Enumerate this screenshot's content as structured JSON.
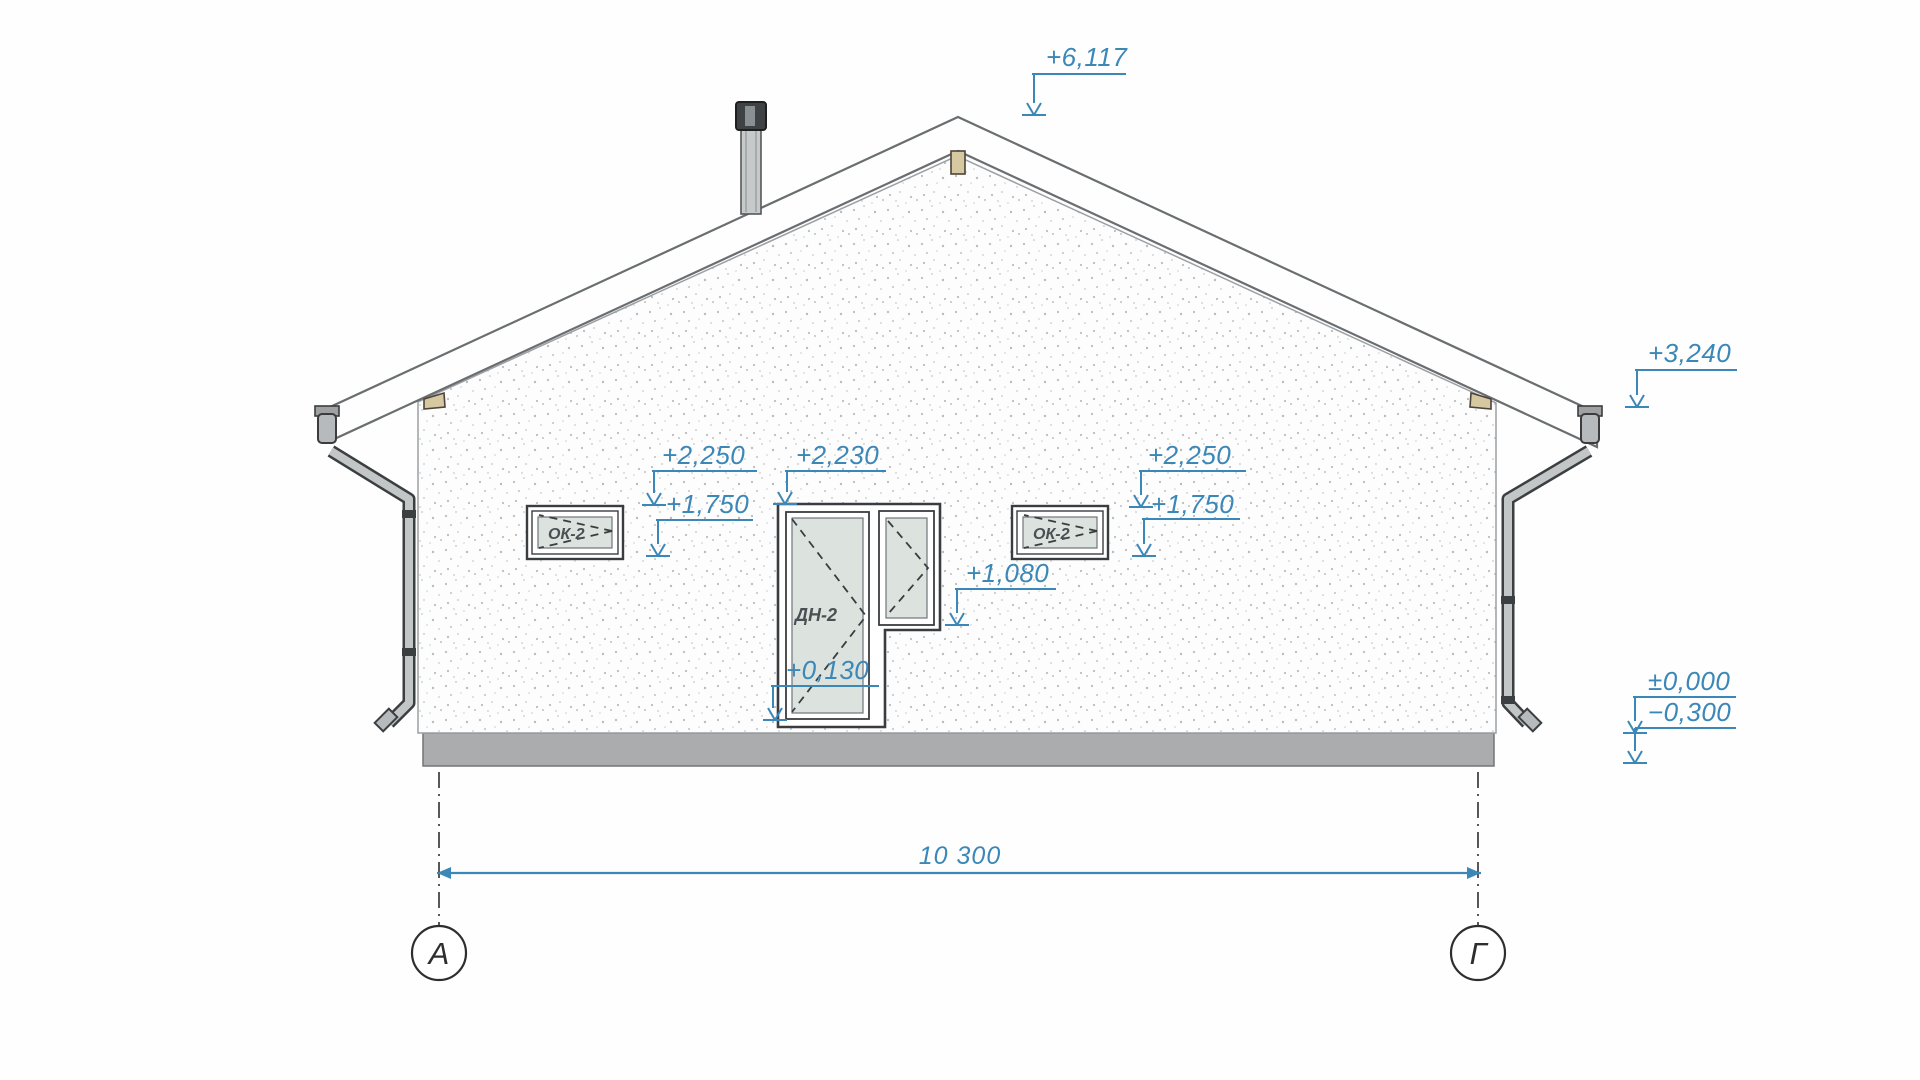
{
  "drawing": {
    "kind": "house-facade-elevation",
    "colors": {
      "annotation_blue": "#3b87b8",
      "outline_dark": "#3a3d3f",
      "roof_line": "#6a6e70",
      "plinth_gray": "#aaacad",
      "glass_fill": "#dce2de",
      "wood_tan": "#d6c8a0",
      "wall_fill": "#fdfdfe"
    }
  },
  "elevation_marks": {
    "ridge": "+6,117",
    "eaves": "+3,240",
    "left_window_head": "+2,250",
    "left_window_sill": "+1,750",
    "door_head": "+2,230",
    "right_window_head": "+2,250",
    "right_window_sill": "+1,750",
    "sidelight_sill": "+1,080",
    "threshold": "+0,130",
    "ground_zero": "±0,000",
    "ground_below": "−0,300"
  },
  "dimensions": {
    "overall_width": "10 300"
  },
  "axes": {
    "left": "А",
    "right": "Г"
  },
  "openings": {
    "window_left": "ОК-2",
    "window_right": "ОК-2",
    "door": "ДН-2"
  }
}
